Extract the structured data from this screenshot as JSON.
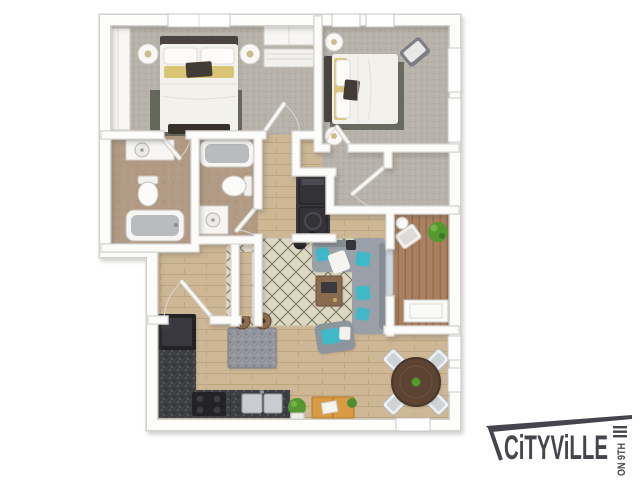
{
  "logo": {
    "brand": "CiTYViLLE",
    "suffix": "ON 9TH",
    "color": "#45454d"
  },
  "palette": {
    "wall": "#fcfcfb",
    "wall_edge": "#d4d2cf",
    "carpet": "#b7b3aa",
    "wood": "#cdb795",
    "tile": "#b19b84",
    "deck": "#aa8160",
    "granite": "#3e3f43",
    "granite_light": "#94969e",
    "sofa": "#99a0a8",
    "teal": "#3fb8c9",
    "yellow": "#d8c575",
    "rug": "#ded8c3",
    "rug_line": "#70755f",
    "appliance": "#232327",
    "plant": "#55982f",
    "box": "#d89a42"
  },
  "scene": {
    "type": "3d-floor-plan",
    "unit": "two-bedroom-two-bath-apartment",
    "rooms": [
      {
        "id": "bedroom-1",
        "features": [
          "bed",
          "nightstands",
          "table-lamps",
          "wardrobe",
          "built-in-closet",
          "window",
          "bench"
        ]
      },
      {
        "id": "bedroom-2",
        "features": [
          "bed",
          "nightstands",
          "accent-chair",
          "area-rug",
          "windows"
        ]
      },
      {
        "id": "bathroom-1",
        "features": [
          "vanity-sink",
          "toilet",
          "bathtub"
        ]
      },
      {
        "id": "bathroom-2",
        "features": [
          "bathtub",
          "toilet",
          "vanity-sink"
        ]
      },
      {
        "id": "hallway",
        "features": []
      },
      {
        "id": "laundry-closet",
        "features": [
          "stacked-washer-dryer"
        ]
      },
      {
        "id": "walk-in-closet",
        "features": []
      },
      {
        "id": "coat-closet",
        "features": []
      },
      {
        "id": "pantry-closet",
        "features": [
          "sliding-door"
        ]
      },
      {
        "id": "living-room",
        "features": [
          "sectional-sofa",
          "teal-pillows",
          "area-rug",
          "coffee-table",
          "armchair",
          "side-tables"
        ]
      },
      {
        "id": "kitchen",
        "features": [
          "refrigerator",
          "l-shaped-granite-counter",
          "range",
          "double-sink",
          "island",
          "bar-stools",
          "potted-plant",
          "moving-box"
        ]
      },
      {
        "id": "dining-area",
        "features": [
          "round-table",
          "four-chairs",
          "windows"
        ]
      },
      {
        "id": "balcony",
        "features": [
          "wood-deck",
          "lounge-chair",
          "side-table",
          "potted-plant",
          "storage-closet",
          "sliding-glass-door"
        ]
      }
    ]
  }
}
